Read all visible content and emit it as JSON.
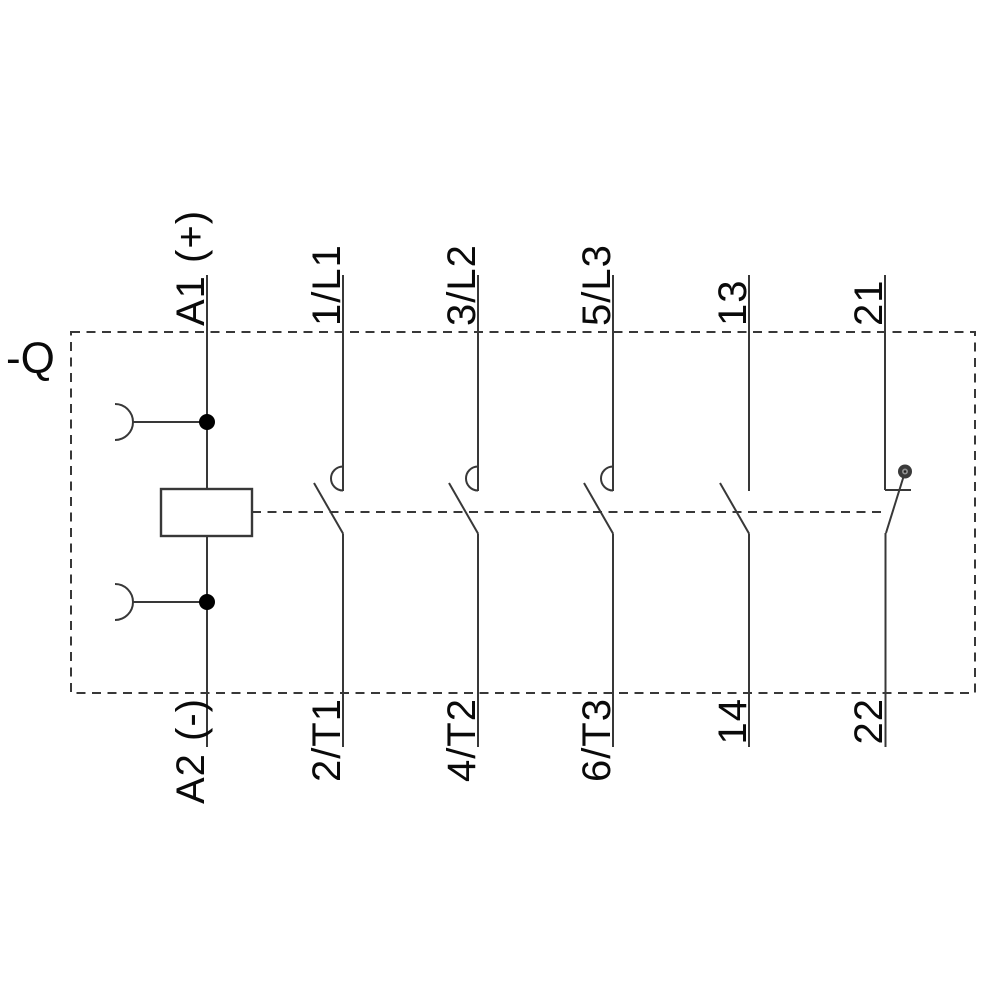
{
  "device": {
    "tag": "-Q"
  },
  "labels": {
    "top": [
      "A1 (+)",
      "1/L1",
      "3/L2",
      "5/L3",
      "13",
      "21"
    ],
    "bottom": [
      "A2 (-)",
      "2/T1",
      "4/T2",
      "6/T3",
      "14",
      "22"
    ]
  },
  "symbols": {
    "coil": "coil-rectangle",
    "main_contacts": "no-main-contact-with-arc-hook",
    "aux_contact_no": "no-auxiliary-contact",
    "aux_contact_nc": "nc-auxiliary-contact-with-pivot-marker",
    "linkage": "mechanical-linkage-dashed-line",
    "clamp": "coil-terminal-clamp-arc"
  },
  "colors": {
    "background": "#ffffff",
    "line": "#383838",
    "text": "#0a0a0a",
    "junction": "#000000",
    "pivot_outer": "#3a3a3a",
    "pivot_inner": "#909090",
    "pivot_center": "#222222"
  }
}
